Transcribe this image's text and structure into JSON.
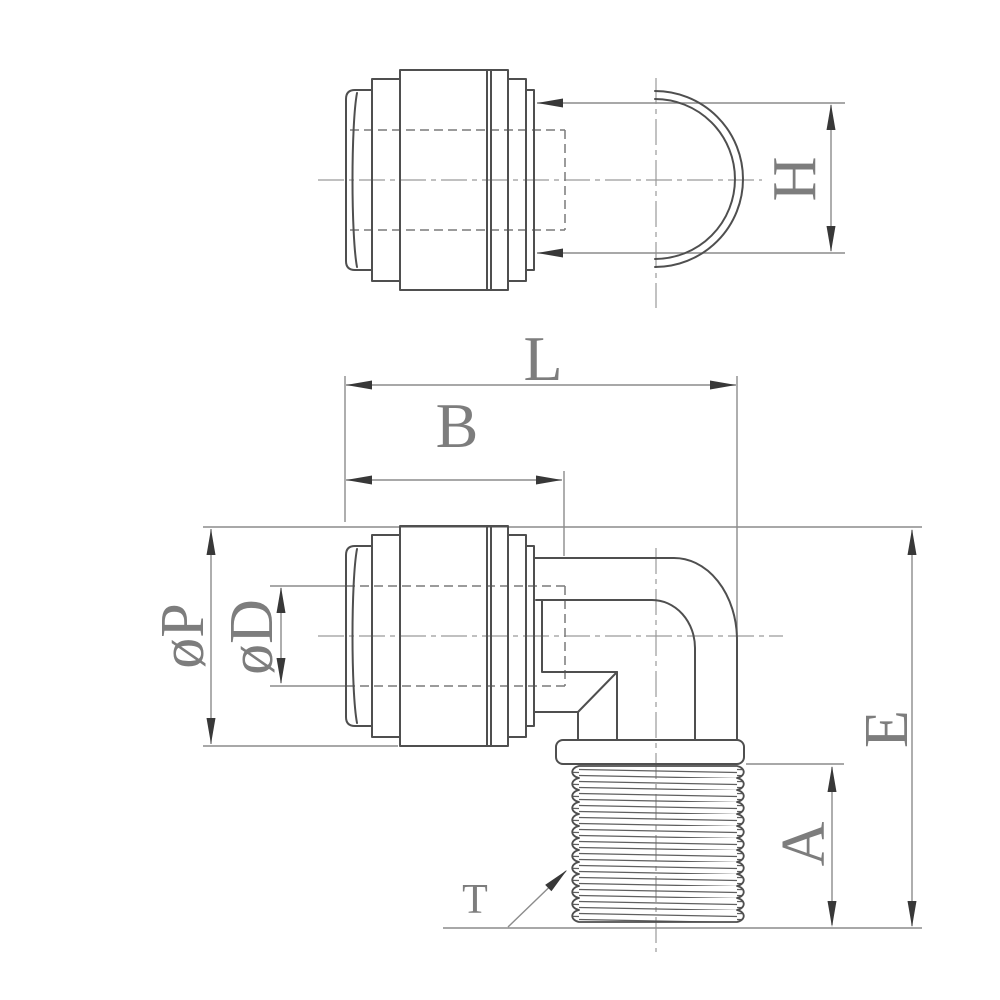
{
  "drawing": {
    "description": "Elbow male connector pneumatic fitting, two-view technical drawing",
    "views": {
      "top_view_name": "top-view",
      "front_view_name": "front-view"
    },
    "dimension_labels": {
      "h": "H",
      "l": "L",
      "b": "B",
      "phi_p": "øP",
      "phi_d": "øD",
      "e": "E",
      "a": "A",
      "t": "T"
    },
    "colors": {
      "background": "#ffffff",
      "outline": "#4f4f4f",
      "dimension_line": "#8c8c8c",
      "hidden_line": "#7a7a7a",
      "center_line": "#9a9a9a",
      "arrowhead": "#383838",
      "label_text": "#7d7d7d",
      "thread_line": "#5f5f5f"
    }
  }
}
